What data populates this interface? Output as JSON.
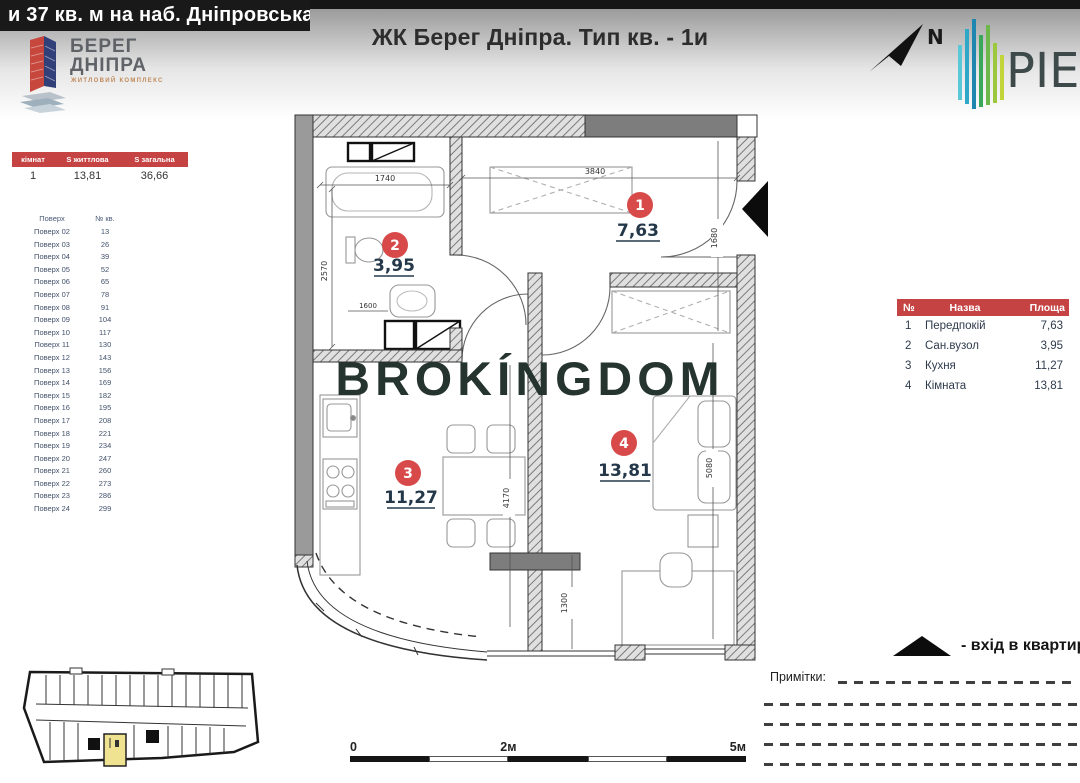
{
  "topbar": {
    "title": "и 37 кв. м на наб. Дніпровська 17в"
  },
  "brand": {
    "name_line1": "БЕРЕГ",
    "name_line2": "ДНІПРА",
    "subtitle": "ЖИТЛОВИЙ КОМПЛЕКС"
  },
  "header": {
    "title": "ЖК Берег Дніпра. Тип кв. - 1и",
    "north": "N",
    "partner": "РІЕЛ"
  },
  "summary": {
    "headers": [
      "кімнат",
      "S життлова",
      "S загальна"
    ],
    "values": [
      "1",
      "13,81",
      "36,66"
    ]
  },
  "floors": {
    "headers": [
      "Поверх",
      "№ кв."
    ],
    "rows": [
      {
        "f": "Поверх 02",
        "n": "13"
      },
      {
        "f": "Поверх 03",
        "n": "26"
      },
      {
        "f": "Поверх 04",
        "n": "39"
      },
      {
        "f": "Поверх 05",
        "n": "52"
      },
      {
        "f": "Поверх 06",
        "n": "65"
      },
      {
        "f": "Поверх 07",
        "n": "78"
      },
      {
        "f": "Поверх 08",
        "n": "91"
      },
      {
        "f": "Поверх 09",
        "n": "104"
      },
      {
        "f": "Поверх 10",
        "n": "117"
      },
      {
        "f": "Поверх 11",
        "n": "130"
      },
      {
        "f": "Поверх 12",
        "n": "143"
      },
      {
        "f": "Поверх 13",
        "n": "156"
      },
      {
        "f": "Поверх 14",
        "n": "169"
      },
      {
        "f": "Поверх 15",
        "n": "182"
      },
      {
        "f": "Поверх 16",
        "n": "195"
      },
      {
        "f": "Поверх 17",
        "n": "208"
      },
      {
        "f": "Поверх 18",
        "n": "221"
      },
      {
        "f": "Поверх 19",
        "n": "234"
      },
      {
        "f": "Поверх 20",
        "n": "247"
      },
      {
        "f": "Поверх 21",
        "n": "260"
      },
      {
        "f": "Поверх 22",
        "n": "273"
      },
      {
        "f": "Поверх 23",
        "n": "286"
      },
      {
        "f": "Поверх 24",
        "n": "299"
      }
    ]
  },
  "plan": {
    "watermark": "BROKÍNGDOM",
    "markers": [
      {
        "num": "1",
        "area": "7,63"
      },
      {
        "num": "2",
        "area": "3,95"
      },
      {
        "num": "3",
        "area": "11,27"
      },
      {
        "num": "4",
        "area": "13,81"
      }
    ],
    "dims": {
      "bath_width": "1740",
      "hall_width": "3840",
      "bath_height": "2570",
      "sink": "1600",
      "entry": "1680",
      "kitchen_height": "4170",
      "room_height": "5080",
      "bottom": "1300"
    }
  },
  "rooms_table": {
    "headers": [
      "№",
      "Назва",
      "Площа"
    ],
    "rows": [
      {
        "num": "1",
        "name": "Передпокій",
        "area": "7,63"
      },
      {
        "num": "2",
        "name": "Сан.вузол",
        "area": "3,95"
      },
      {
        "num": "3",
        "name": "Кухня",
        "area": "11,27"
      },
      {
        "num": "4",
        "name": "Кімната",
        "area": "13,81"
      }
    ]
  },
  "legend": {
    "entrance_label": "-  вхід в квартиру",
    "notes_label": "Примітки:"
  },
  "scale": {
    "t0": "0",
    "t2": "2м",
    "t5": "5м"
  },
  "colors": {
    "accent_red": "#c64343",
    "marker_red": "#d84a4a",
    "watermark": "#263430",
    "topbar_bg": "#161616",
    "wall_gray": "#7d7d7d"
  }
}
